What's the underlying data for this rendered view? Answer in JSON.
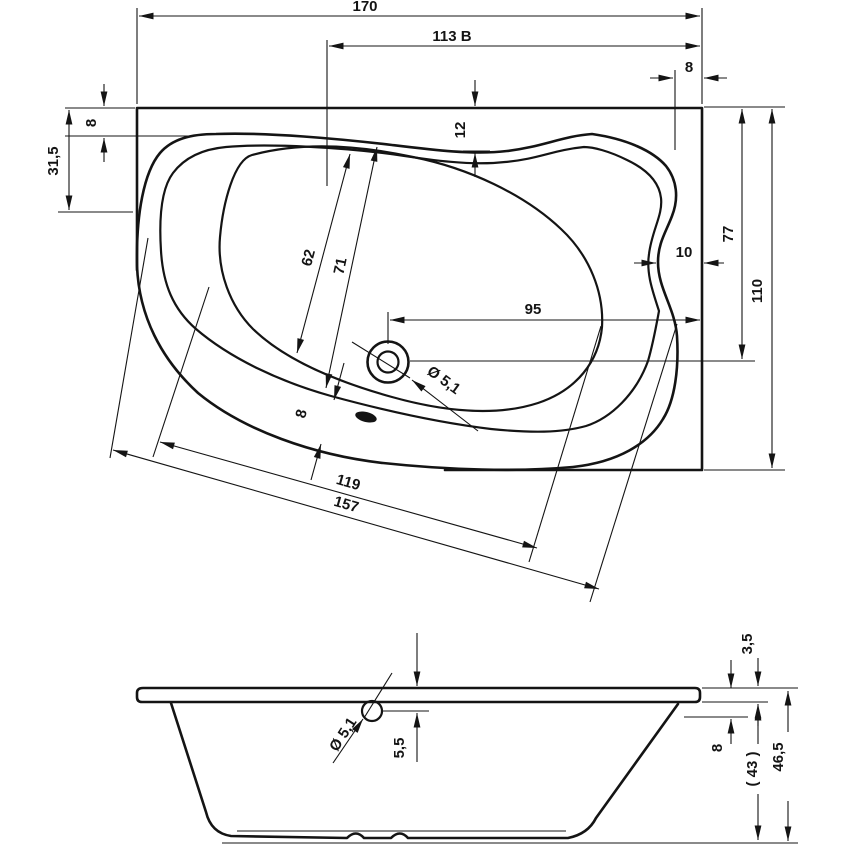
{
  "drawing": {
    "colors": {
      "line": "#141414",
      "background": "#ffffff"
    },
    "top_view": {
      "labels": {
        "overall_length": "170",
        "length_b": "113 B",
        "rim_offset_top_right": "8",
        "rim_width_top_left": "8",
        "front_edge_offset": "31,5",
        "rim_width_top_mid": "12",
        "well_width_inner": "62",
        "well_width_outer": "71",
        "drain_offset_depth": "77",
        "rim_width_right": "10",
        "drain_offset_length": "95",
        "overall_depth": "110",
        "drain_diameter": "Ø 5,1",
        "rim_width_bottom": "8",
        "well_length": "119",
        "tub_length": "157"
      }
    },
    "side_view": {
      "labels": {
        "rim_thickness": "3,5",
        "overflow_drop": "5,5",
        "overflow_diameter": "Ø 5,1",
        "rim_edge_height": "8",
        "inner_depth": "( 43 )",
        "total_height": "46,5"
      }
    }
  }
}
